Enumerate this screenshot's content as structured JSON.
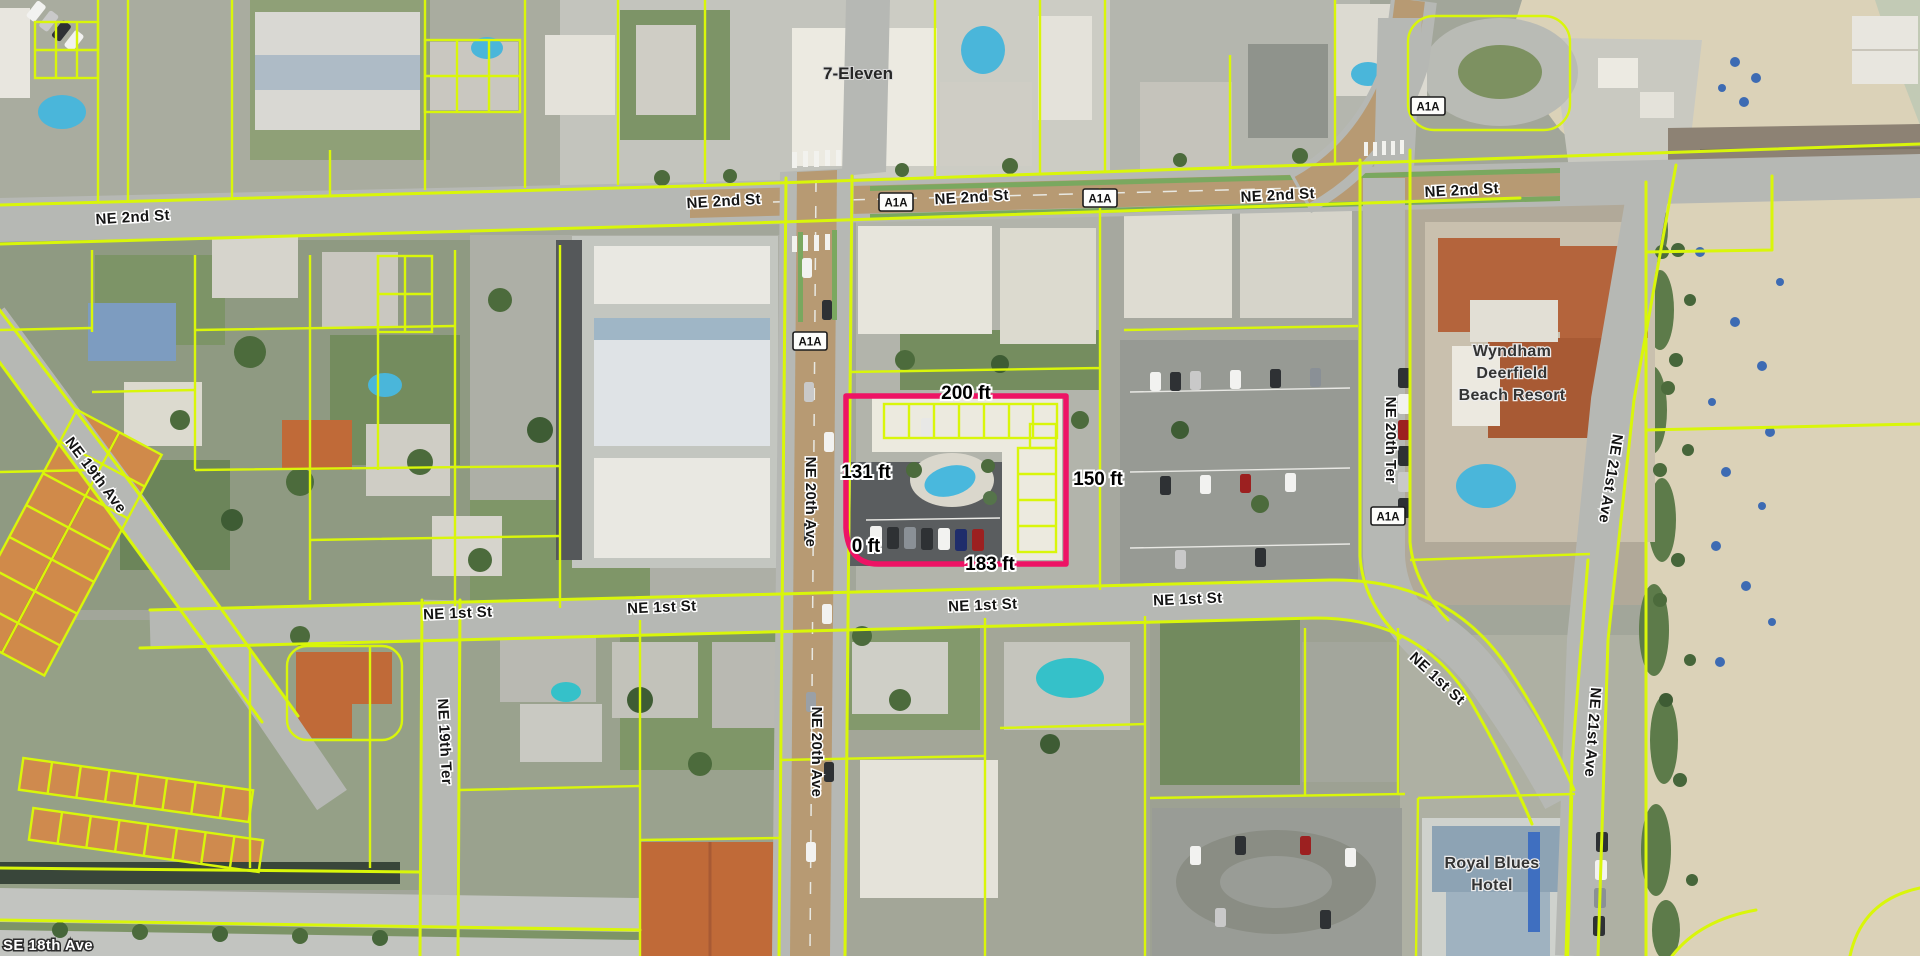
{
  "map": {
    "street_labels": [
      {
        "text": "NE 2nd St"
      },
      {
        "text": "NE 2nd St"
      },
      {
        "text": "NE 2nd St"
      },
      {
        "text": "NE 2nd St"
      },
      {
        "text": "NE 2nd St"
      },
      {
        "text": "NE 1st St"
      },
      {
        "text": "NE 1st St"
      },
      {
        "text": "NE 1st St"
      },
      {
        "text": "NE 1st St"
      },
      {
        "text": "NE 1st St"
      },
      {
        "text": "NE 20th Ave"
      },
      {
        "text": "NE 20th Ave"
      },
      {
        "text": "NE 20th Ter"
      },
      {
        "text": "NE 21st Ave"
      },
      {
        "text": "NE 21st Ave"
      },
      {
        "text": "NE 19th Ave"
      },
      {
        "text": "NE 19th Ter"
      },
      {
        "text": "SE 18th Ave"
      }
    ],
    "route_shields": [
      {
        "text": "A1A"
      },
      {
        "text": "A1A"
      },
      {
        "text": "A1A"
      },
      {
        "text": "A1A"
      },
      {
        "text": "A1A"
      }
    ],
    "places": {
      "seven_eleven": "7-Eleven",
      "wyndham": {
        "line1": "Wyndham",
        "line2": "Deerfield",
        "line3": "Beach Resort"
      },
      "royal_blues": {
        "line1": "Royal Blues",
        "line2": "Hotel"
      }
    },
    "highlighted_parcel": {
      "outline_color": "#ee1365",
      "measurements": {
        "top": "200 ft",
        "left": "131 ft",
        "right": "150 ft",
        "corner": "0 ft",
        "bottom": "183 ft"
      }
    },
    "colors": {
      "parcel_line": "#d9f60a",
      "highlight": "#ee1365",
      "arterial_road": "#b79a73",
      "road": "#b6b8b4",
      "sand": "#dbd2b8"
    }
  }
}
